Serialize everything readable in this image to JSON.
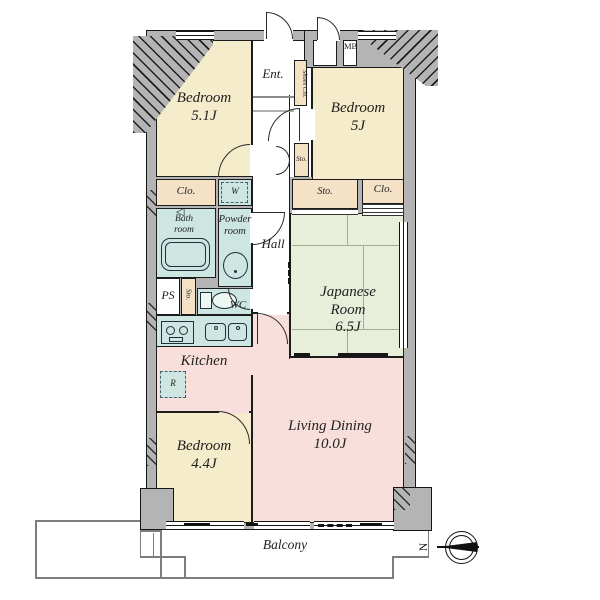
{
  "palette": {
    "wall": "#b4b4b4",
    "bedroom": "#f4ecca",
    "closet": "#f4e1c6",
    "wet_area": "#cde6e2",
    "tatami": "#e7efdb",
    "living": "#f9dfdb",
    "outline": "#1c1c1c"
  },
  "rooms": {
    "bedroom1": {
      "name": "Bedroom",
      "size": "5.1J"
    },
    "bedroom2": {
      "name": "Bedroom",
      "size": "5J"
    },
    "bedroom3": {
      "name": "Bedroom",
      "size": "4.4J"
    },
    "japanese_room": {
      "line1": "Japanese",
      "line2": "Room",
      "size": "6.5J"
    },
    "living_dining": {
      "name": "Living Dining",
      "size": "10.0J"
    },
    "kitchen": {
      "name": "Kitchen"
    },
    "bath": {
      "line1": "Bath",
      "line2": "room"
    },
    "powder": {
      "line1": "Powder",
      "line2": "room"
    },
    "wc": "WC",
    "hall": "Hall",
    "entrance": "Ent.",
    "ps": "PS",
    "balcony": "Balcony"
  },
  "storage": {
    "closet_left": "Clo.",
    "closet_right": "Clo.",
    "shoes_closet": "Shoes Clo.",
    "sto_hall": "Sto.",
    "sto_japanese": "Sto.",
    "sto_wc": "Sto.",
    "washer": "W",
    "fridge": "R",
    "meter_box": "MB"
  },
  "compass": {
    "north": "N"
  }
}
